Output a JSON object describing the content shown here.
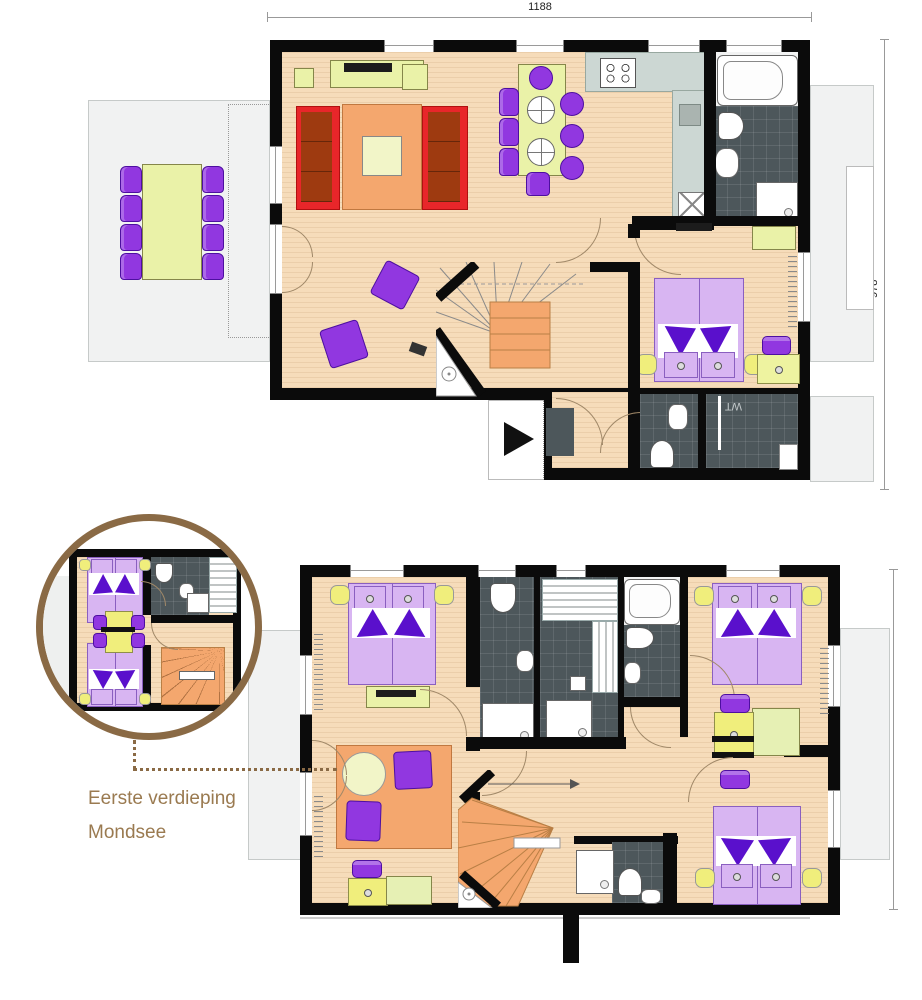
{
  "labels": {
    "caption_line1": "Eerste verdieping",
    "caption_line2": "Mondsee",
    "room_wt": "WT"
  },
  "dims": {
    "top_width": "1188",
    "top_height": "978",
    "bottom_height": "778"
  },
  "icons": {
    "entry_arrow": "right-arrow",
    "stairs": "winder-staircase",
    "detail_lens": "circular-detail-inset"
  },
  "colors": {
    "floor": "#f6dcba",
    "bath": "#4d575b",
    "terrace": "#f1f2f2",
    "purple": "#9137e0",
    "bed": "#d8b5f2",
    "fold": "#5a10cc",
    "sofa_red": "#e8262a",
    "sofa_cushion": "#9e3a10",
    "rug": "#f4a76e",
    "stair": "#f4a76e",
    "green": "#eaf2a8",
    "yellow": "#f0ee7c",
    "kitchen": "#ccd7d3",
    "brown": "#8a6a45",
    "caption": "#9a7a50"
  }
}
